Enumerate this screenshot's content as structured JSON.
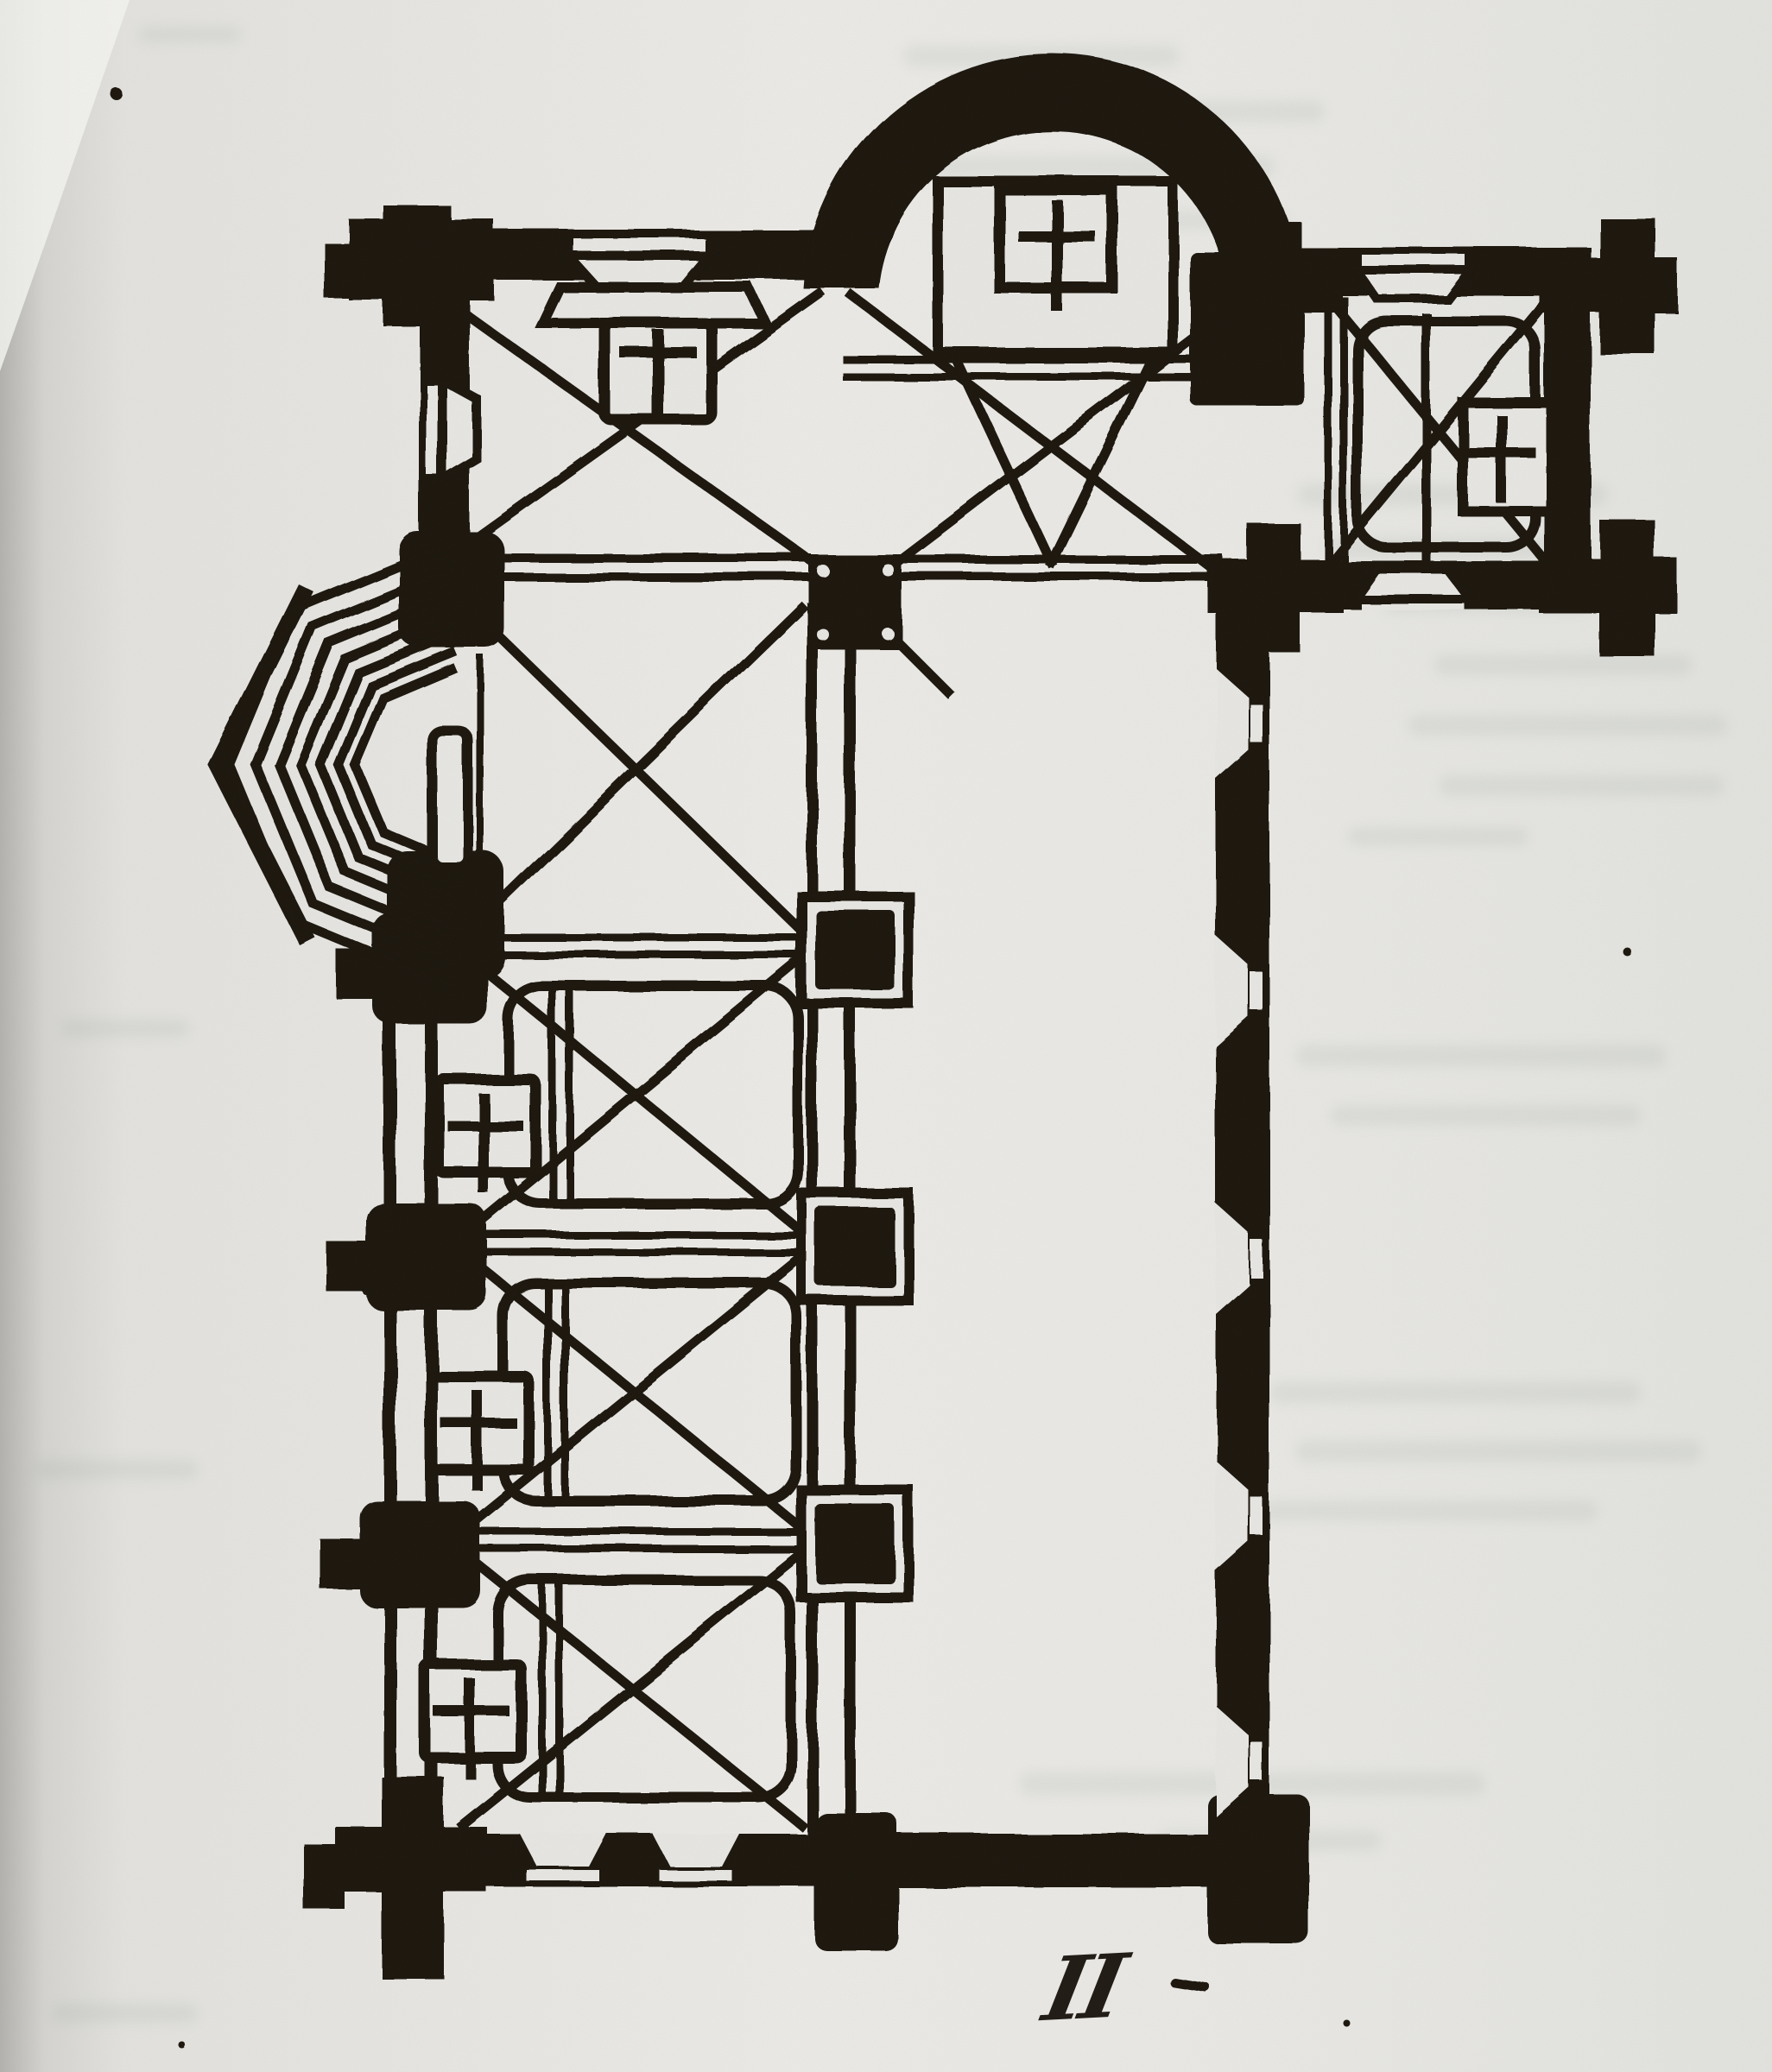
{
  "figure": {
    "kind": "scanned book page with engraved church floor plan",
    "caption": "II",
    "ink_color": "#1a150e",
    "paper_color": "#e7e6e2",
    "parts": [
      "main apse (semicircular) with square sanctuary and altar cross",
      "narthex bay with wall altar, splayed windows and cross vault",
      "choir bay with cross vault and double step lines",
      "right side chapel with altar cross and four corner buttress piers",
      "left stepped apse of seven concentric half-octagon orders with altar slab",
      "central arcade with five square piers",
      "three aisle chapels with rounded vaulted bays and wall altars",
      "nave side wall with five splayed windows",
      "bottom wall with two splayed windows and corner buttresses"
    ]
  }
}
